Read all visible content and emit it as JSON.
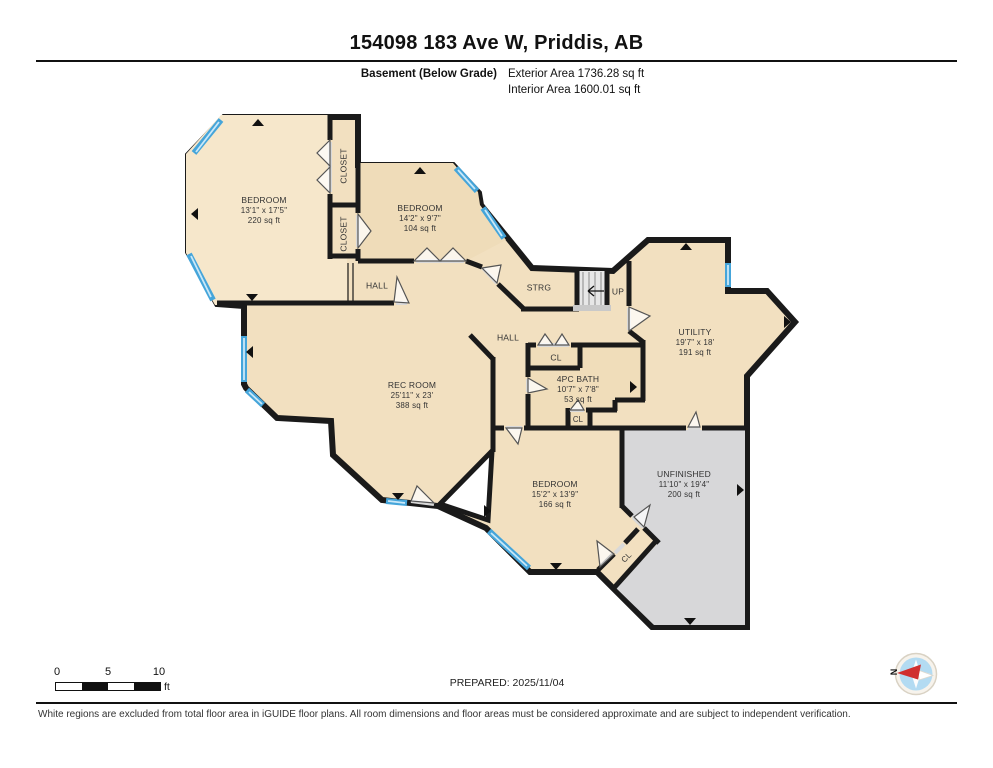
{
  "header": {
    "title": "154098 183 Ave W, Priddis, AB",
    "floor": "Basement (Below Grade)",
    "exterior_area": "Exterior Area 1736.28 sq ft",
    "interior_area": "Interior Area 1600.01 sq ft"
  },
  "rooms": {
    "bedroom1": {
      "name": "BEDROOM",
      "dims": "13'1\" x 17'5\"",
      "area": "220 sq ft"
    },
    "closet1": {
      "name": "CLOSET"
    },
    "closet2": {
      "name": "CLOSET"
    },
    "bedroom2": {
      "name": "BEDROOM",
      "dims": "14'2\" x 9'7\"",
      "area": "104 sq ft"
    },
    "hall_upper": {
      "name": "HALL"
    },
    "strg": {
      "name": "STRG"
    },
    "up": {
      "name": "UP"
    },
    "hall_central": {
      "name": "HALL"
    },
    "utility": {
      "name": "UTILITY",
      "dims": "19'7\" x 18'",
      "area": "191 sq ft"
    },
    "rec_room": {
      "name": "REC ROOM",
      "dims": "25'11\" x 23'",
      "area": "388 sq ft"
    },
    "cl_hall": {
      "name": "CL"
    },
    "bath": {
      "name": "4PC BATH",
      "dims": "10'7\" x 7'8\"",
      "area": "53 sq ft"
    },
    "cl_bath": {
      "name": "CL"
    },
    "bedroom3": {
      "name": "BEDROOM",
      "dims": "15'2\" x 13'9\"",
      "area": "166 sq ft"
    },
    "unfinished": {
      "name": "UNFINISHED",
      "dims": "11'10\" x 19'4\"",
      "area": "200 sq ft"
    },
    "cl_diag": {
      "name": "CL"
    }
  },
  "scale_bar": {
    "labels": [
      "0",
      "5",
      "10"
    ],
    "unit": "ft"
  },
  "prepared": "PREPARED: 2025/11/04",
  "compass": {
    "label": "N"
  },
  "footer": {
    "disclaimer": "White regions are excluded from total floor area in iGUIDE floor plans. All room dimensions and floor areas must be considered approximate and are subject to independent verification."
  },
  "colors": {
    "wall": "#1a1a1a",
    "floor_tan": "#f2e0c0",
    "unfinished_gray": "#d7d7d9",
    "window_blue": "#45a5da",
    "compass_blue": "#b3dbf2",
    "compass_needle_red": "#d02f2f"
  }
}
